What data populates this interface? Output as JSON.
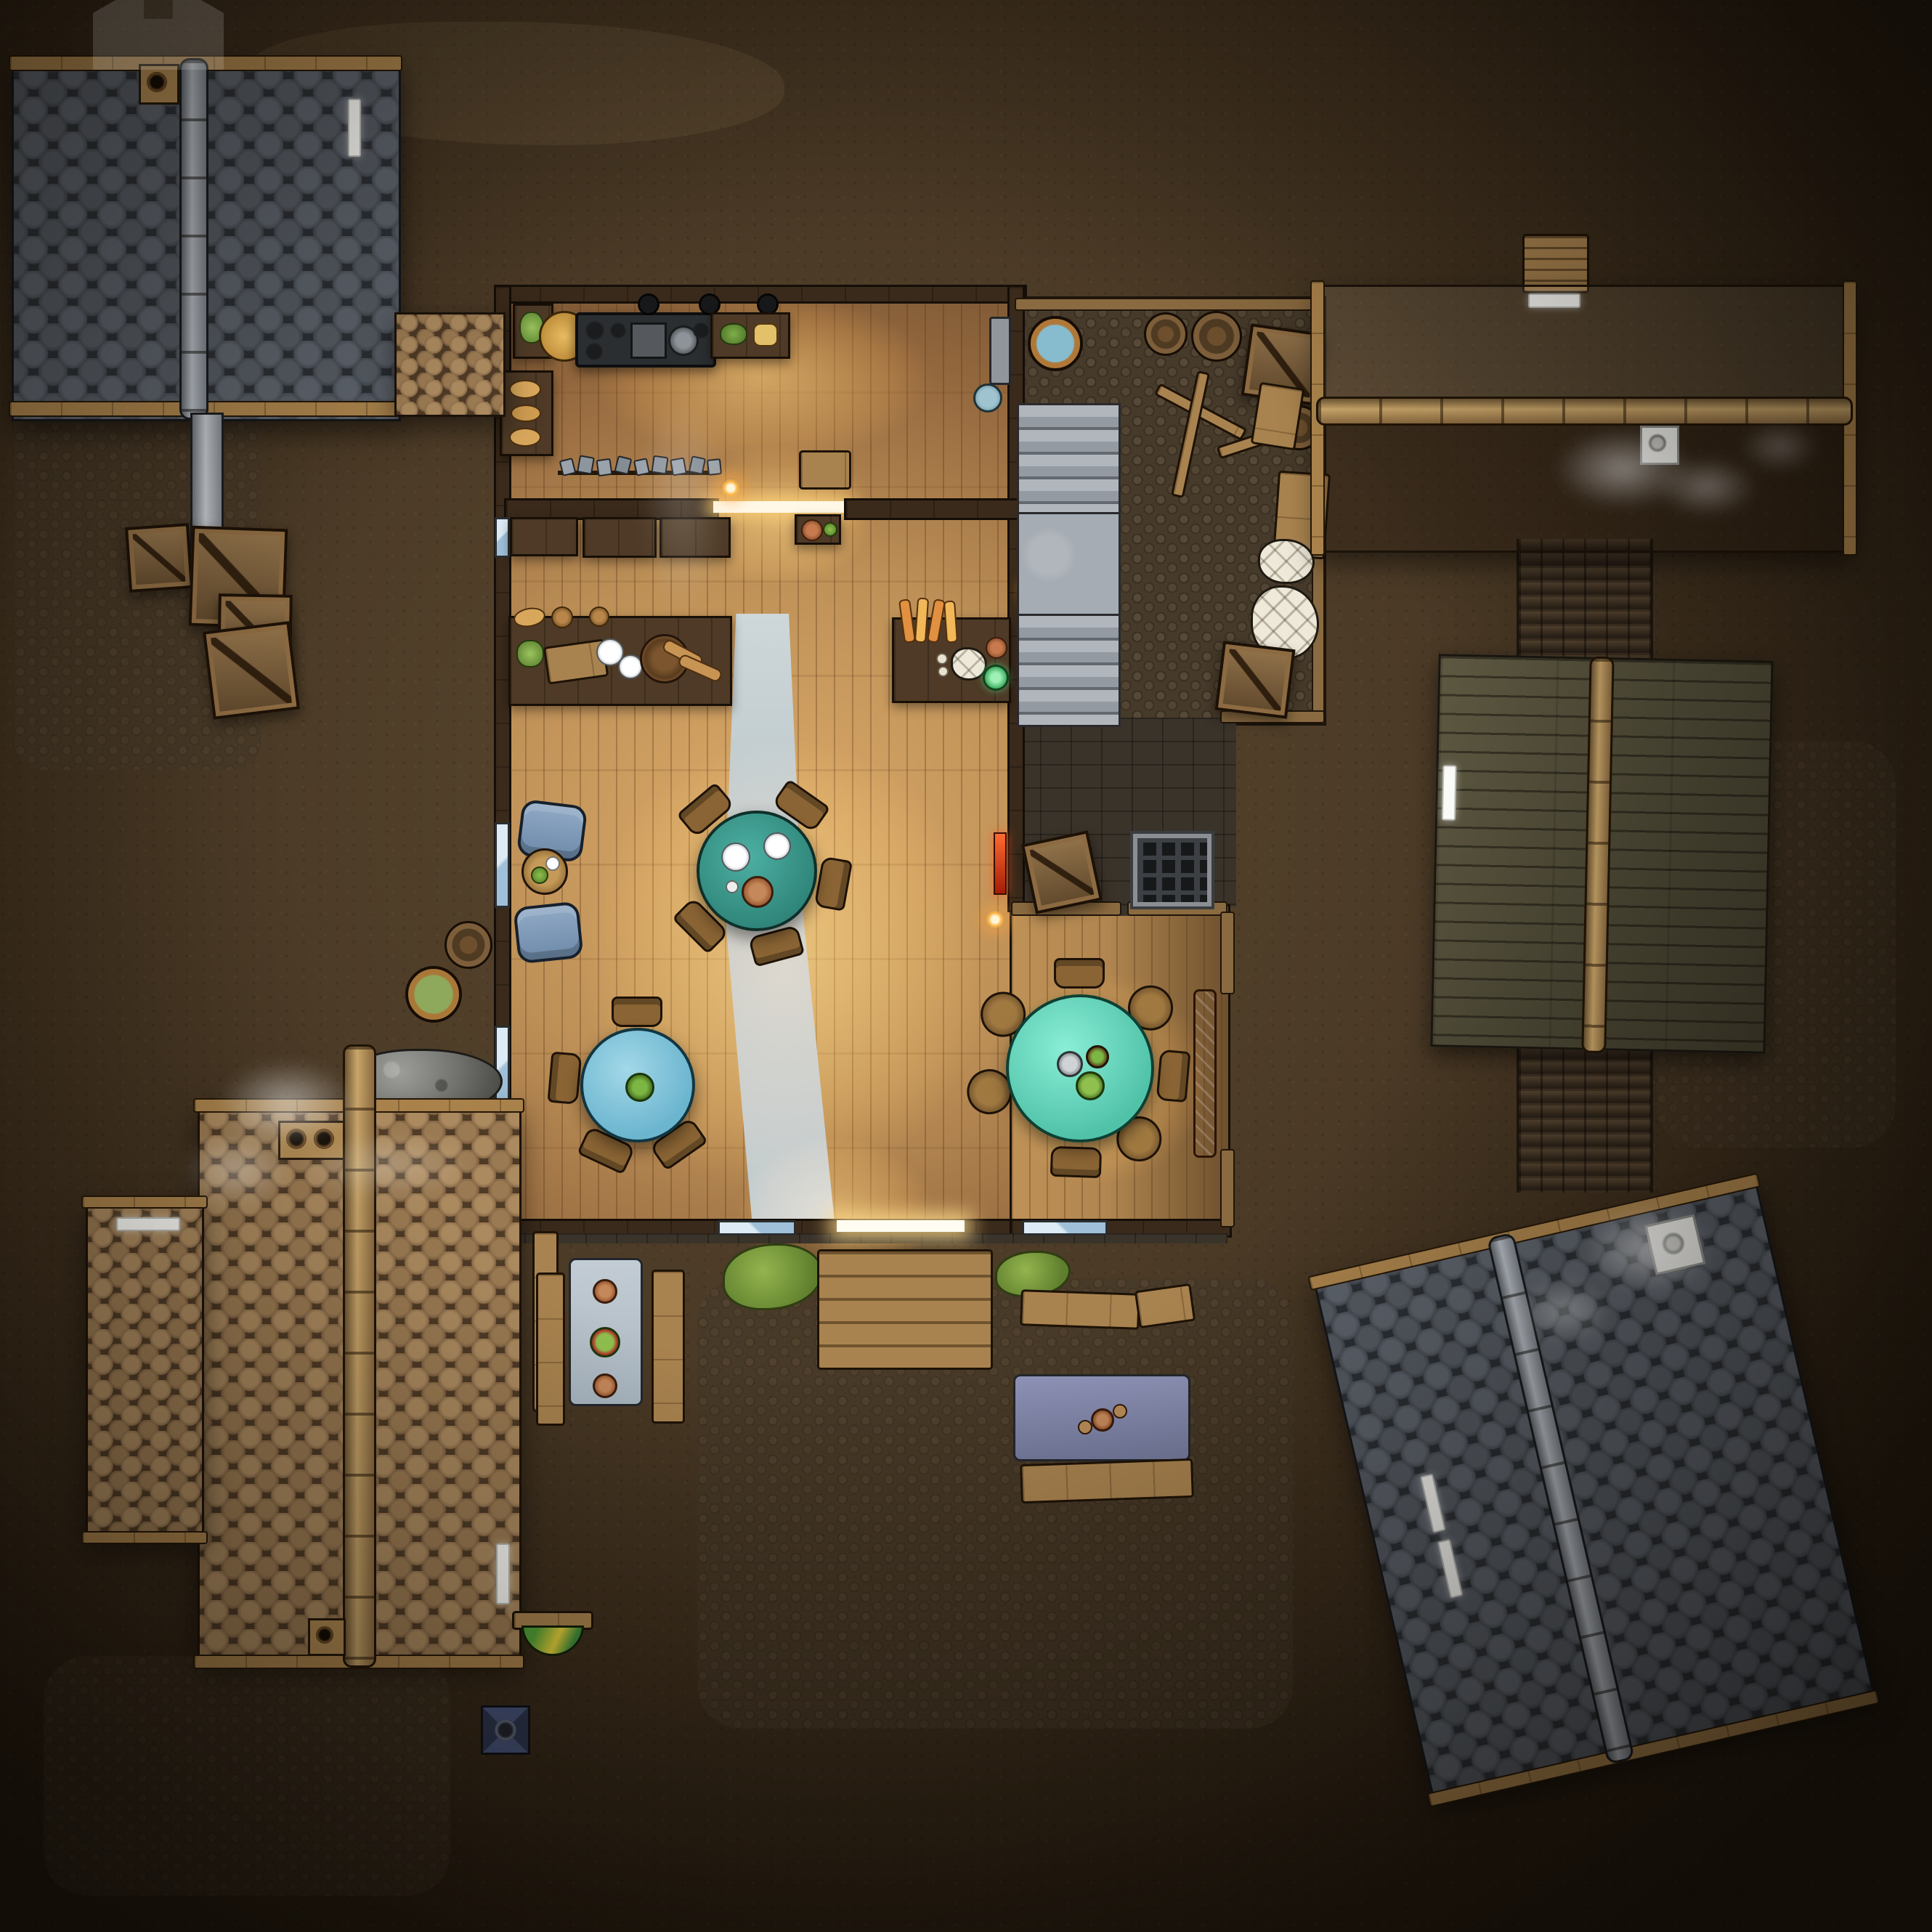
{
  "scene": {
    "title": "Top-down tavern battle map",
    "art_style": "hand-drawn fantasy RPG map, night scene with warm interior lantern light",
    "ground": "packed dirt with cobblestone patches and cracked mud",
    "no_visible_text": true
  },
  "watermark": {
    "icon": "house-logo-icon",
    "position": "top-left",
    "style": "faint translucent house silhouette"
  },
  "palette": {
    "dirt": "#4b3a26",
    "slate_roof": "#42474e",
    "slate_ridge": "#b7bdc5",
    "brown_shingle": "#8d6e4b",
    "eave_wood": "#a9824b",
    "tavern_wall": "#3a2a1b",
    "floor_lit": "#dba968",
    "deck": "#b0854f",
    "carpet": "#c6d0d2",
    "table_teal": "#3da095",
    "table_sky_blue": "#85c8dc",
    "table_mint": "#72dfc7",
    "armchair_blue": "#7e9cba",
    "water": "#7fb6c9",
    "brew_green": "#8aa658",
    "glow": "#ffaa46",
    "grass": "#7fa03e",
    "lean_to_planks": "#55503b",
    "stairs": "#a6acb3"
  },
  "buildings": [
    {
      "id": "building-nw",
      "roof": "dark slate scallop shingles",
      "ridge": "stone cap, vertical",
      "chimney": "wooden flue with round pipe",
      "skylights": 1,
      "drainpipe": true
    },
    {
      "id": "awning-west",
      "roof": "brown shingle awning connecting NW building to tavern"
    },
    {
      "id": "tavern",
      "roof": "open (interior visible)",
      "rooms": [
        "kitchen",
        "bar",
        "dining hall",
        "porch",
        "back yard"
      ]
    },
    {
      "id": "building-ne",
      "roof": "wood shingles, lighter upper slope",
      "ridge": "log beam, horizontal",
      "chimney": "white stone flue with smoke",
      "skylights": 1,
      "extras": [
        "lumber stack at ridge top"
      ]
    },
    {
      "id": "lean-to-east",
      "roof": "weathered gray-green planks over log road",
      "ridge": "wood beam, vertical",
      "skylights": 1
    },
    {
      "id": "building-se",
      "roof": "dark slate scallop shingles",
      "rotation_deg": -13,
      "ridge": "stone cap, diagonal",
      "chimney": "white stone flue with smoke",
      "skylights": 2
    },
    {
      "id": "building-sw-large",
      "roof": "wood shingles",
      "ridge": "log beam, vertical",
      "chimneys": 2,
      "skylights": 1,
      "smoke": true
    },
    {
      "id": "building-sw-small",
      "roof": "wood shingles",
      "skylights": 1
    }
  ],
  "tavern_interior": {
    "kitchen": [
      "iron stove with burners and hanging pots",
      "golden cheese wheel",
      "cutting board with greens",
      "bread shelf",
      "herb counter",
      "wash basin",
      "blue plate"
    ],
    "bar": [
      "tankard rack with gray mugs",
      "long counter with bread, plates, basket and baguettes",
      "three cabinets",
      "hanging wooden sign",
      "baguette crate counter",
      "garlic and jars",
      "candle lantern"
    ],
    "hall": [
      "gray runner carpet",
      "two blue tufted armchairs",
      "round side table with salad bowl",
      "red wall banner",
      "wall lanterns"
    ],
    "tables": [
      {
        "id": "table-north",
        "top_color": "#3da095",
        "seats": 5,
        "items": [
          "plates",
          "terracotta bowl",
          "cutlery"
        ]
      },
      {
        "id": "table-west",
        "top_color": "#85c8dc",
        "seats": 4,
        "items": [
          "potted plant"
        ]
      },
      {
        "id": "table-porch",
        "top_color": "#72dfc7",
        "seats": 7,
        "items": [
          "potted plants",
          "candle tray"
        ]
      }
    ],
    "porch": [
      "plank deck",
      "railing",
      "orange trestle table",
      "stone foundation band"
    ],
    "back_yard": [
      "cobbled ground",
      "rain barrel with water",
      "two barrels",
      "crates",
      "flour sacks",
      "stone staircase with landing",
      "broken planks",
      "wooden fence",
      "cellar grate",
      "scattered lumber"
    ]
  },
  "outdoor_props": [
    "4 crates below NW building",
    "gray drainpipe",
    "barrel with green brew",
    "closed barrel",
    "gray rubble pile",
    "west dining set: two benches + gray cloth table with plates and flowers",
    "tavern entry steps",
    "grass tufts",
    "east picnic set: benches + purple cloth table with mug tray",
    "lone bench",
    "plank with green-yellow shield",
    "blue brazier plate",
    "corduroy log road",
    "3 smoke plumes"
  ]
}
